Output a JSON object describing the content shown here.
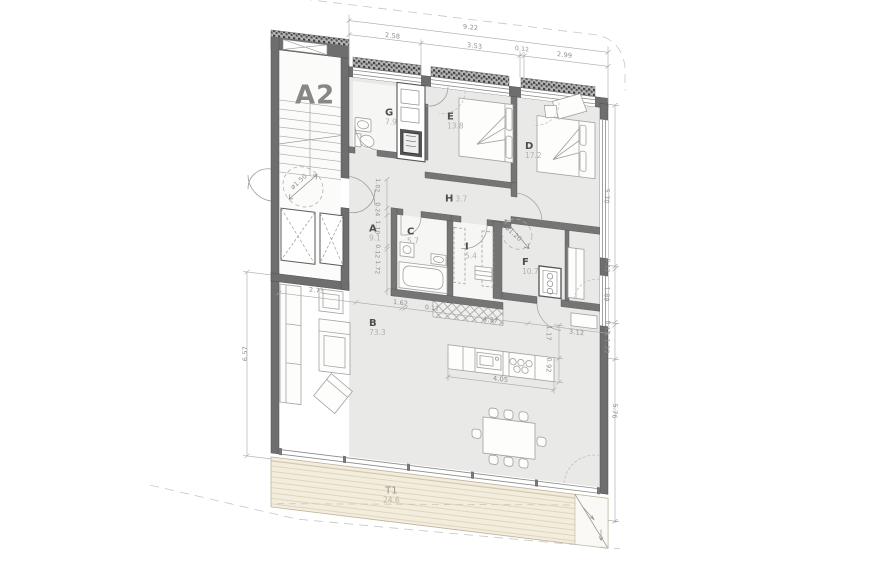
{
  "plan": {
    "unit": "A2",
    "rooms": {
      "g": {
        "letter": "G",
        "area": "7.9"
      },
      "e": {
        "letter": "E",
        "area": "13.8"
      },
      "d": {
        "letter": "D",
        "area": "17.2"
      },
      "h": {
        "letter": "H",
        "area": "3.7"
      },
      "a": {
        "letter": "A",
        "area": "9.1"
      },
      "c": {
        "letter": "C",
        "area": "5.7"
      },
      "i": {
        "letter": "I",
        "area": "5.4"
      },
      "f": {
        "letter": "F",
        "area": "10.7"
      },
      "b": {
        "letter": "B",
        "area": "73.3"
      },
      "t1": {
        "letter": "T1",
        "area": "24.6"
      }
    },
    "dims": {
      "top_total": "9.22",
      "top_1": "2.58",
      "top_2": "3.53",
      "top_3": "0.12",
      "top_4": "2.99",
      "right_1": "5.70",
      "right_2": "0.12",
      "right_3": "1.89",
      "right_4": "0.12",
      "right_5": "1.22",
      "right_6": "5.76",
      "left_1": "6.57",
      "mid_1": "2.73",
      "mid_2": "1.62",
      "mid_3": "0.12",
      "mid_4": "4.37",
      "mid_5": "3.12",
      "kitchen_w": "4.05",
      "kitchen_d": "0.92",
      "kitchen_gap": "1.17",
      "corr_1": "1.02",
      "corr_2": "0.24",
      "corr_3": "1.10",
      "corr_4": "0.12",
      "corr_5": "1.72",
      "circle_lobby": "ø1.50",
      "circle_room_f": "ø1.20"
    }
  }
}
